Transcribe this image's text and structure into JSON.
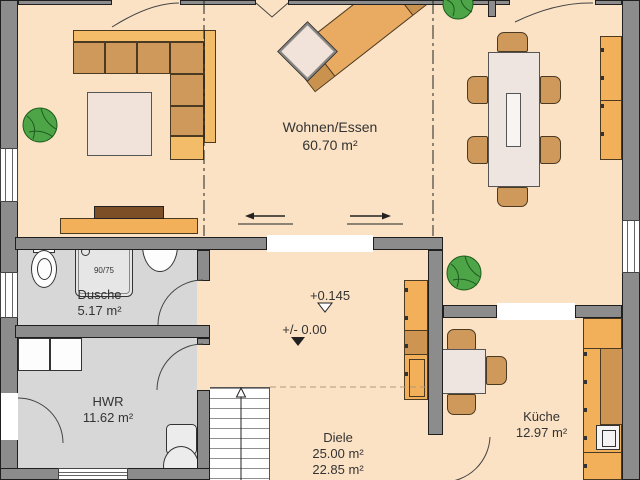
{
  "plan": {
    "title": "floor-plan-ground-floor",
    "rooms": {
      "living": {
        "name": "Wohnen/Essen",
        "area": "60.70 m²"
      },
      "shower": {
        "name": "Dusche",
        "area": "5.17 m²"
      },
      "utility": {
        "name": "HWR",
        "area": "11.62 m²"
      },
      "hall": {
        "name": "Diele",
        "area1": "25.00 m²",
        "area2": "22.85 m²"
      },
      "kitchen": {
        "name": "Küche",
        "area": "12.97 m²"
      }
    },
    "annotations": {
      "level_upper": "+0.145",
      "level_zero": "+/- 0.00",
      "shower_tray_size": "90/75"
    },
    "colors": {
      "floor_peach": "#fbe2c4",
      "floor_wet_gray": "#d7d7d7",
      "wall_gray": "#8c8c8c",
      "furniture_orange": "#f2b05a",
      "furniture_tan": "#d0995c",
      "wood_dark": "#cd9452",
      "table_cream": "#eee4e0",
      "plant_green": "#4da547"
    }
  }
}
